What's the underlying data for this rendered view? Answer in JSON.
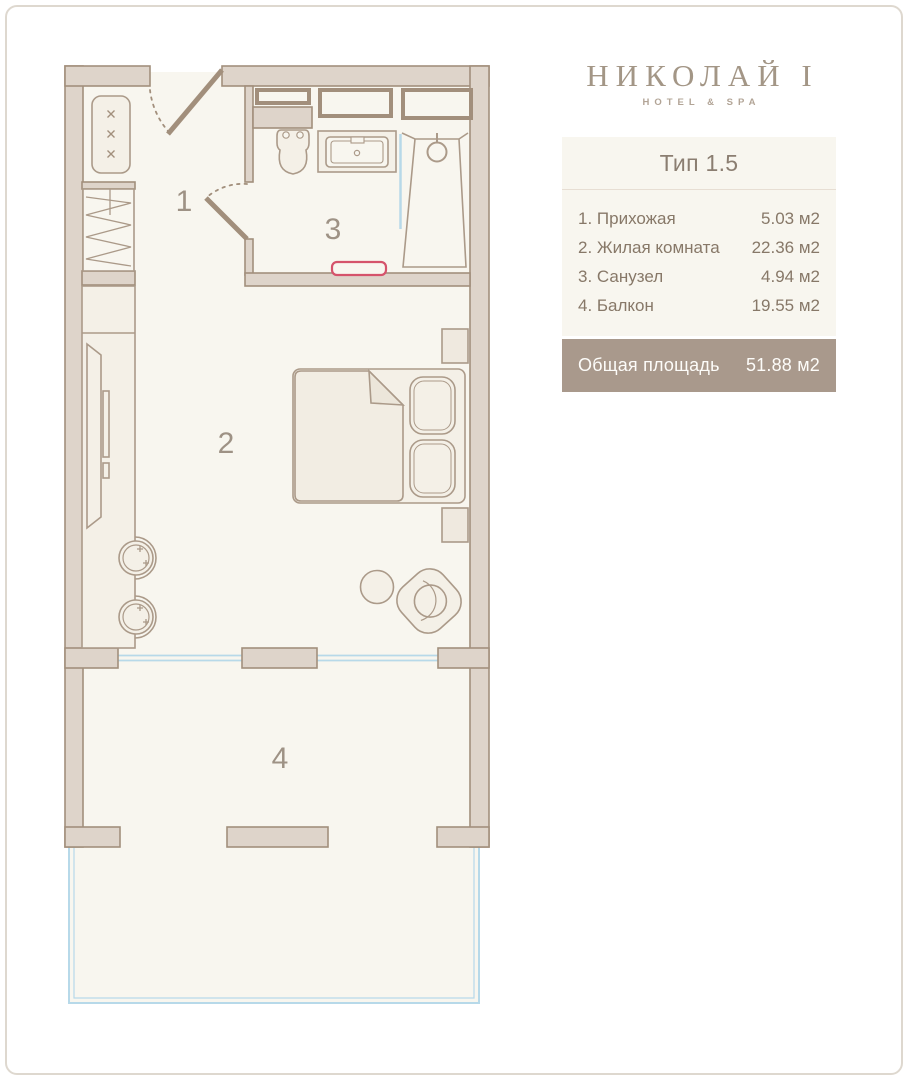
{
  "brand": {
    "name": "НИКОЛАЙ I",
    "tagline": "HOTEL & SPA"
  },
  "panel": {
    "title": "Тип 1.5"
  },
  "rooms": [
    {
      "label": "1. Прихожая",
      "area": "5.03 м2"
    },
    {
      "label": "2. Жилая комната",
      "area": "22.36 м2"
    },
    {
      "label": "3. Санузел",
      "area": "4.94 м2"
    },
    {
      "label": "4. Балкон",
      "area": "19.55 м2"
    }
  ],
  "total": {
    "label": "Общая площадь",
    "area": "51.88 м2"
  },
  "plan": {
    "room_labels": [
      "1",
      "2",
      "3",
      "4"
    ]
  },
  "colors": {
    "wall_fill": "#ded4ca",
    "wall_stroke": "#a28f7c",
    "floor": "#f8f6ef",
    "furniture_fill": "#f4f0e7",
    "glass_blue": "#b7d9e9",
    "mat_accent": "#d5536b",
    "panel_bg": "#f8f6ef",
    "total_bar_bg": "#a9998c",
    "text_brown": "#877868",
    "logo_color": "#a39686"
  }
}
